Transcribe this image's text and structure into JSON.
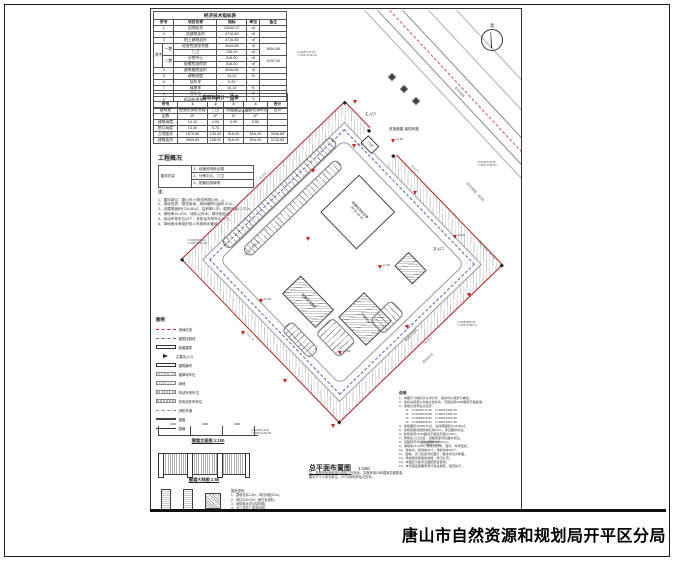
{
  "footer": {
    "agency": "唐山市自然资源和规划局开平区分局"
  },
  "north": {
    "label": "北"
  },
  "indicator_table": {
    "name": "economic-indicator-table",
    "title": "经济技术指标表",
    "widths": [
      9,
      11,
      42,
      29,
      13,
      26
    ],
    "header": [
      {
        "t": "序号",
        "cs": 2
      },
      "项目名称",
      "指标",
      "单位",
      "备注"
    ],
    "rows": [
      [
        {
          "t": "1",
          "cs": 2
        },
        "用地面积",
        "23045.37",
        "㎡",
        ""
      ],
      [
        {
          "t": "2",
          "cs": 2
        },
        "总建筑面积",
        "4716.85",
        "㎡",
        ""
      ],
      [
        {
          "t": "3",
          "cs": 2
        },
        "地上建筑面积",
        "4716.85",
        "㎡",
        ""
      ],
      [
        {
          "t": "其中",
          "rs": 4
        },
        {
          "t": "一期",
          "rs": 2
        },
        "经营检测综合楼",
        "3549.85",
        "㎡",
        {
          "t": "3684.85",
          "rs": 2
        }
      ],
      [
        "门卫",
        "135.00",
        "㎡"
      ],
      [
        {
          "t": "二期",
          "rs": 2
        },
        "分拣中心",
        "516.00",
        "㎡",
        {
          "t": "1032.00",
          "rs": 2
        }
      ],
      [
        "配套检测库房",
        "516.00",
        "㎡"
      ],
      [
        {
          "t": "4",
          "cs": 2
        },
        "建筑基底面积",
        "3046.85",
        "㎡",
        ""
      ],
      [
        {
          "t": "5",
          "cs": 2
        },
        "建筑密度",
        "13.22",
        "%",
        ""
      ],
      [
        {
          "t": "6",
          "cs": 2
        },
        "容积率",
        "0.20",
        "",
        ""
      ],
      [
        {
          "t": "7",
          "cs": 2
        },
        "绿地率",
        "15.10",
        "%",
        ""
      ],
      [
        {
          "t": "8",
          "cs": 2
        },
        "停车位",
        "56",
        "个",
        ""
      ],
      [
        {
          "t": "9",
          "cs": 2
        },
        "机动车停车位",
        "20",
        "个",
        ""
      ],
      [
        {
          "t": "10",
          "cs": 2
        },
        "非机动车停车位",
        "40",
        "个",
        ""
      ]
    ]
  },
  "building_table": {
    "name": "building-list-table",
    "title": "建筑物统计一览表",
    "widths": [
      24,
      30,
      16,
      20,
      24,
      20
    ],
    "header": [
      "序号",
      "1",
      "2",
      "3",
      "4",
      "合计"
    ],
    "rows": [
      [
        "建筑物",
        "经营检测综合楼",
        "门卫",
        "分拣中心",
        "配套检测库房",
        "总计"
      ],
      [
        "层数",
        "2F",
        "1F",
        "1F",
        "1F",
        ""
      ],
      [
        "建筑高度",
        "14.10",
        "4.00",
        "9.90",
        "5.50",
        ""
      ],
      [
        "檐口高度",
        "13.40",
        "3.70",
        "",
        "",
        ""
      ],
      [
        "占地面积",
        "1879.85",
        "135.00",
        "516.00",
        "516.00",
        "3046.85"
      ],
      [
        "建筑面积",
        "3549.85",
        "135.00",
        "516.00",
        "516.00",
        "4716.85"
      ]
    ]
  },
  "overview": {
    "title": "工程概况",
    "comp_label": "建设内容",
    "comp_items": [
      "1、经营检测综合楼",
      "2、分拣中心、门卫",
      "3、配套检测库房"
    ],
    "notes_label": "注：",
    "notes": [
      "1、建设单位：唐山市××物流有限公司。",
      "2、用地性质：物流用地，用地面积23045.37㎡。",
      "3、总建筑面积4716.85㎡，容积率0.20，建筑密度13.22%。",
      "4、绿地率15.10%，绿化以乔木、草坪相结合。",
      "5、机动车停车位20个，非机动车停车位40个。",
      "6、场地雨水有组织排入市政雨水管网。"
    ]
  },
  "legend": {
    "title": "图例",
    "items": [
      {
        "sym": "red-dash",
        "label": "用地红线"
      },
      {
        "sym": "blue-dash",
        "label": "建筑控制线"
      },
      {
        "sym": "rect",
        "label": "新建建筑"
      },
      {
        "sym": "arrow",
        "label": "主要出入口"
      },
      {
        "sym": "numbox",
        "label": "建筑编号"
      },
      {
        "sym": "hatch1",
        "label": "植草砖车位"
      },
      {
        "sym": "hatch2",
        "label": "绿地"
      },
      {
        "sym": "stripes",
        "label": "机动车停车位"
      },
      {
        "sym": "stripes2",
        "label": "非机动车停车位"
      },
      {
        "sym": "dash-gray",
        "label": "消防车道"
      },
      {
        "sym": "double-line",
        "label": "道路"
      },
      {
        "sym": "tick-line",
        "label": "围墙"
      }
    ]
  },
  "fence": {
    "elev_title": "围墙立面图 1:100",
    "detail_title": "围墙大样图 1:50",
    "dims": [
      "3000",
      "3000",
      "3000"
    ],
    "notes": [
      "围墙说明：",
      "1、围墙总高1.8m，砖柱间距3.0m。",
      "2、砖柱240×240，刷白色涂料。",
      "3、墙体做法详见结构图。",
      "4、大门详见厂家深化图。"
    ]
  },
  "plan_title": {
    "title": "总平面布置图",
    "scale": "1:500"
  },
  "plan_notes": [
    "注：本图坐标采用唐山市独立坐标系，高程采用1985国家高程基准。",
    "图中尺寸以米为单位，X/Y为用地界址点坐标。"
  ],
  "notes_block": {
    "label": "说明:",
    "lines": [
      "1、本图尺寸除标高以米计外，其余均以毫米为单位。",
      "2、坐标采用唐山市独立坐标系，高程采用1985国家高程基准。",
      "3、用地红线界址点坐标：",
      "　　J1　X=4283771.25　Y=40571206.15",
      "　　J2　X=4283640.89　Y=40571352.20",
      "　　J3　X=4283478.63　Y=40571203.48",
      "　　J4　X=4283609.12　Y=40571057.36",
      "4、用地面积23045.37㎡，总建筑面积4716.85㎡。",
      "5、建筑控制线退用地红线5.0m，详见图中标注。",
      "6、新建建筑±0.00相当于绝对高程12.60m。",
      "7、场地出入口位置、道路宽度详见图中标注。",
      "8、道路转弯半径除注明外均为6.0m。",
      "9、绿地率15.10%，绿化以乔木、灌木、草坪结合。",
      "10、停车位：机动车20个，非机动车40个。",
      "11、围墙、大门位置详见图示，做法详见大样图。",
      "12、场地雨水有组织排放，雨污分流。",
      "13、本图应与各专业图纸配合使用。",
      "14、未尽事宜按国家现行有关规范、规定执行。"
    ]
  },
  "site": {
    "edge_dims": {
      "top": "219.77",
      "right": "224.91",
      "bottom": "219.77",
      "left": "224.91"
    },
    "buildings": [
      {
        "x": 62,
        "y": 40,
        "w": 52,
        "h": 54,
        "cls": "",
        "lines": [
          "经营检测综合楼",
          "2F  H=14.10"
        ]
      },
      {
        "x": 40,
        "y": 6,
        "w": 16,
        "h": 11,
        "cls": "",
        "lines": [
          "门卫"
        ]
      },
      {
        "x": 150,
        "y": 118,
        "w": 40,
        "h": 36,
        "cls": "hatch",
        "lines": [
          "分拣中心"
        ]
      },
      {
        "x": 94,
        "y": 152,
        "w": 48,
        "h": 26,
        "cls": "hatch",
        "lines": [
          "配套检测库房"
        ]
      },
      {
        "x": 152,
        "y": 58,
        "w": 26,
        "h": 20,
        "cls": "hatch",
        "lines": []
      }
    ],
    "parking": [
      {
        "x": 14,
        "y": 34,
        "w": 12,
        "h": 152,
        "dir": "v"
      },
      {
        "x": 34,
        "y": 46,
        "w": 12,
        "h": 130,
        "dir": "v"
      },
      {
        "x": 146,
        "y": 158,
        "w": 34,
        "h": 24,
        "dir": "h"
      },
      {
        "x": 174,
        "y": 104,
        "w": 20,
        "h": 30,
        "dir": "v"
      },
      {
        "x": 120,
        "y": 190,
        "w": 40,
        "h": 14,
        "dir": "h"
      }
    ],
    "road_lines": [
      {
        "x": 214,
        "y": 1,
        "len": 240,
        "r": 47,
        "cls": "thin"
      },
      {
        "x": 227,
        "y": 1,
        "len": 222,
        "r": 47,
        "cls": "solid"
      },
      {
        "x": 239,
        "y": 1,
        "len": 204,
        "r": 47,
        "cls": "red-dash"
      },
      {
        "x": 252,
        "y": 1,
        "len": 186,
        "r": 47,
        "cls": "solid"
      },
      {
        "x": 278,
        "y": 1,
        "len": 148,
        "r": 47,
        "cls": "thin"
      },
      {
        "x": 306,
        "y": 1,
        "len": 112,
        "r": 47,
        "cls": "thin"
      }
    ],
    "trees": [
      {
        "x": 238,
        "y": 65
      },
      {
        "x": 250,
        "y": 77
      },
      {
        "x": 262,
        "y": 89
      }
    ],
    "markers": [
      {
        "x": 201,
        "y": 135,
        "t": "12.56"
      },
      {
        "x": 155,
        "y": 228,
        "t": ""
      },
      {
        "x": 108,
        "y": 290,
        "t": "12.60"
      },
      {
        "x": 132,
        "y": 370,
        "t": ""
      },
      {
        "x": 187,
        "y": 342,
        "t": "12.58"
      },
      {
        "x": 254,
        "y": 316,
        "t": ""
      },
      {
        "x": 227,
        "y": 256,
        "t": "12.55"
      },
      {
        "x": 262,
        "y": 182,
        "t": ""
      },
      {
        "x": 302,
        "y": 226,
        "t": "12.62"
      },
      {
        "x": 316,
        "y": 284,
        "t": ""
      },
      {
        "x": 202,
        "y": 91,
        "t": ""
      },
      {
        "x": 180,
        "y": 415,
        "t": ""
      },
      {
        "x": 90,
        "y": 322,
        "t": ""
      },
      {
        "x": 240,
        "y": 130,
        "t": "12.50"
      },
      {
        "x": 160,
        "y": 160,
        "t": ""
      }
    ],
    "labels": [
      {
        "t": "改造道路 接现状路",
        "x": 238,
        "y": 118,
        "r": 0,
        "c": "dark"
      },
      {
        "t": "主入口",
        "x": 214,
        "y": 103,
        "r": 0,
        "c": "dark"
      },
      {
        "t": "次入口",
        "x": 282,
        "y": 238,
        "r": 0,
        "c": "dark"
      },
      {
        "t": "现状道路",
        "x": 306,
        "y": 76,
        "r": 47,
        "c": "gray"
      },
      {
        "t": "现状围墙（拆除）",
        "x": 318,
        "y": 172,
        "r": 47,
        "c": "gray"
      },
      {
        "t": "现状围墙（利用）",
        "x": 330,
        "y": 230,
        "r": 47,
        "c": "gray"
      },
      {
        "t": "用地红线",
        "x": 270,
        "y": 352,
        "r": -44,
        "c": "gray"
      },
      {
        "t": "建筑控制线",
        "x": 252,
        "y": 330,
        "r": -44,
        "c": "gray"
      },
      {
        "t": "植草砖停车位",
        "x": 92,
        "y": 244,
        "r": -44,
        "c": "gray"
      },
      {
        "t": "绿化带",
        "x": 64,
        "y": 196,
        "r": -44,
        "c": "gray"
      }
    ],
    "coords": [
      {
        "x": 146,
        "y": 42,
        "l1": "X=4283771.25",
        "l2": "Y=40571206.15"
      },
      {
        "x": 78,
        "y": 98,
        "l1": "X=4283726.10",
        "l2": "Y=40571124.66"
      },
      {
        "x": 36,
        "y": 230,
        "l1": "X=4283609.12",
        "l2": "Y=40571057.36"
      },
      {
        "x": 100,
        "y": 420,
        "l1": "X=4283478.63",
        "l2": "Y=40571203.48"
      },
      {
        "x": 270,
        "y": 432,
        "l1": "X=4283530.55",
        "l2": "Y=40571300.82"
      },
      {
        "x": 326,
        "y": 152,
        "l1": "X=4283718.40",
        "l2": "Y=40571296.51"
      },
      {
        "x": 306,
        "y": 312,
        "l1": "X=4283566.28",
        "l2": "Y=40571338.74"
      }
    ]
  }
}
